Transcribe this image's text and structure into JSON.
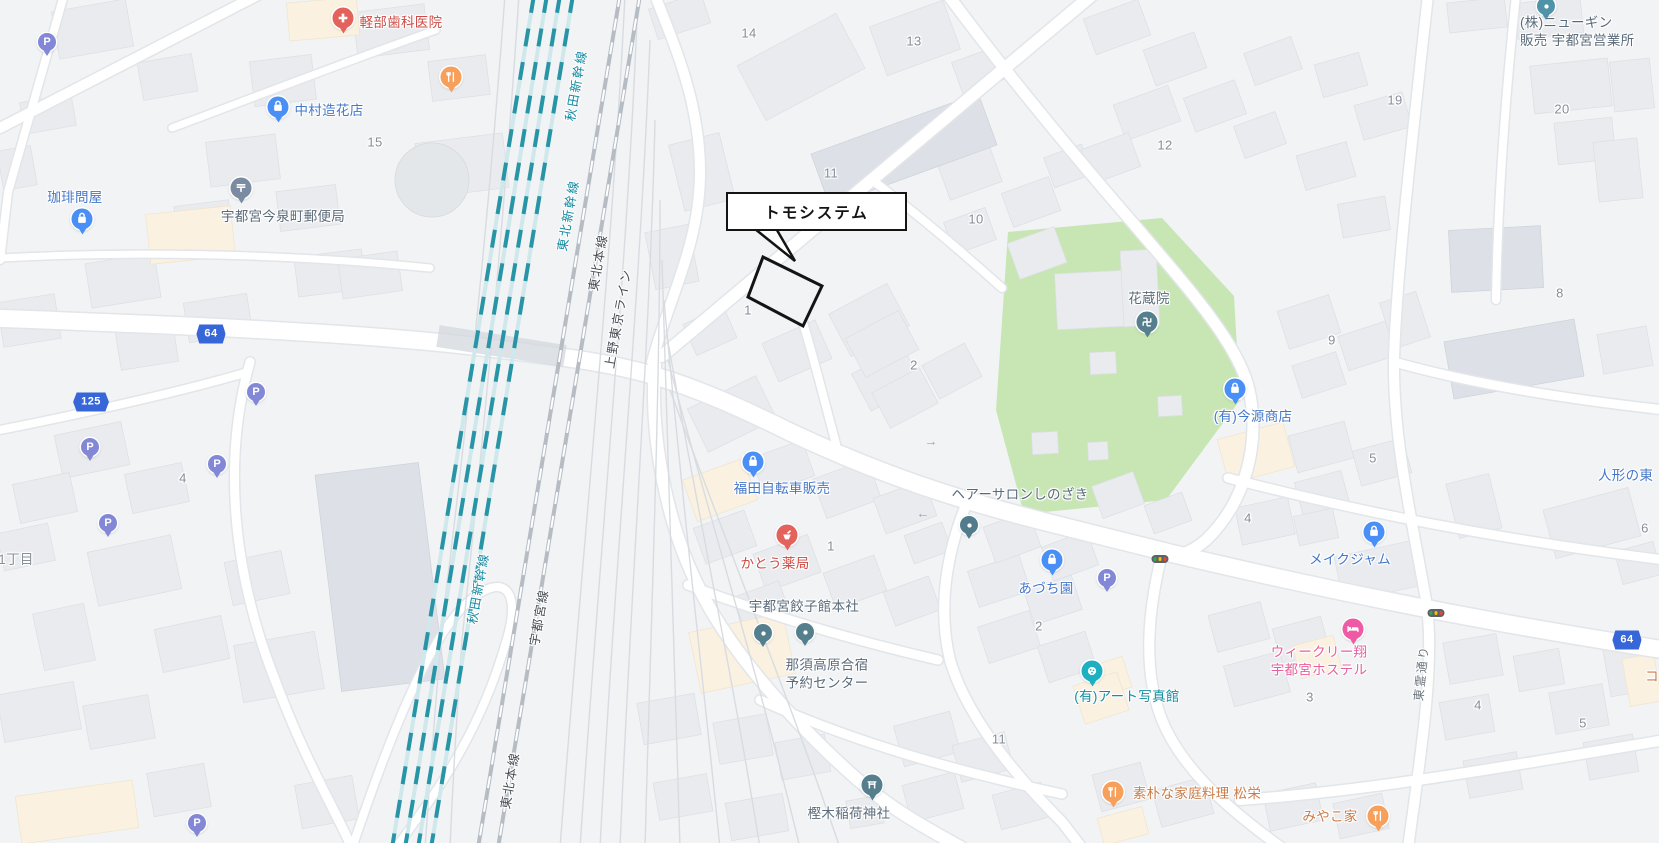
{
  "map": {
    "callout": {
      "text": "トモシステム"
    },
    "poi_labels": [
      {
        "text": "軽部歯科医院",
        "x": 401,
        "y": 23,
        "color": "#cd4b44"
      },
      {
        "text": "中村造花店",
        "x": 329,
        "y": 111,
        "color": "#4577c8"
      },
      {
        "text": "珈琲問屋",
        "x": 75,
        "y": 198,
        "color": "#4577c8"
      },
      {
        "text": "宇都宮今泉町郵便局",
        "x": 283,
        "y": 217,
        "color": "#5a6a7a"
      },
      {
        "text": "(株)ニューギン\n販売 宇都宮営業所",
        "x": 1520,
        "y": 14,
        "color": "#5a6a7a",
        "align": "left"
      },
      {
        "text": "花蔵院",
        "x": 1149,
        "y": 299,
        "color": "#5a6a7a"
      },
      {
        "text": "(有)今源商店",
        "x": 1253,
        "y": 417,
        "color": "#4577c8"
      },
      {
        "text": "人形の東",
        "x": 1598,
        "y": 467,
        "color": "#4577c8",
        "align": "left"
      },
      {
        "text": "福田自転車販売",
        "x": 782,
        "y": 489,
        "color": "#4577c8"
      },
      {
        "text": "かとう薬局",
        "x": 775,
        "y": 564,
        "color": "#cd4b44"
      },
      {
        "text": "ヘアーサロンしのざき",
        "x": 1020,
        "y": 495,
        "color": "#5a6a7a"
      },
      {
        "text": "あづち園",
        "x": 1046,
        "y": 589,
        "color": "#4577c8"
      },
      {
        "text": "(有)アート写真館",
        "x": 1127,
        "y": 697,
        "color": "#128fa0"
      },
      {
        "text": "メイクジャム",
        "x": 1350,
        "y": 560,
        "color": "#4577c8"
      },
      {
        "text": "ウィークリー翔\n宇都宮ホステル",
        "x": 1319,
        "y": 661,
        "color": "#e85f9f"
      },
      {
        "text": "宇都宮餃子館本社",
        "x": 804,
        "y": 607,
        "color": "#5a6a7a"
      },
      {
        "text": "那須高原合宿\n予約センター",
        "x": 827,
        "y": 674,
        "color": "#5a6a7a"
      },
      {
        "text": "樫木稲荷神社",
        "x": 849,
        "y": 814,
        "color": "#5a6a7a"
      },
      {
        "text": "素朴な家庭料理 松栄",
        "x": 1197,
        "y": 794,
        "color": "#c97c48"
      },
      {
        "text": "みやこ家",
        "x": 1330,
        "y": 817,
        "color": "#c97c48"
      },
      {
        "text": "コ",
        "x": 1652,
        "y": 677,
        "color": "#c97c48"
      },
      {
        "text": "1丁目",
        "x": 16,
        "y": 560,
        "color": "#8a919a"
      }
    ],
    "railway_labels": [
      {
        "text": "秋田新幹線",
        "x": 575,
        "y": 85,
        "angle": -80,
        "color": "#1389a0"
      },
      {
        "text": "東北新幹線",
        "x": 567,
        "y": 215,
        "angle": -80,
        "color": "#1389a0"
      },
      {
        "text": "東北本線",
        "x": 597,
        "y": 262,
        "angle": -80,
        "color": "#474e55"
      },
      {
        "text": "上野東京ライン",
        "x": 617,
        "y": 318,
        "angle": -80,
        "color": "#474e55"
      },
      {
        "text": "秋田新幹線",
        "x": 477,
        "y": 588,
        "angle": -80,
        "color": "#1389a0"
      },
      {
        "text": "宇都宮線",
        "x": 538,
        "y": 617,
        "angle": -80,
        "color": "#474e55"
      },
      {
        "text": "東北本線",
        "x": 509,
        "y": 780,
        "angle": -80,
        "color": "#474e55"
      }
    ],
    "street_labels": [
      {
        "text": "東霊通り",
        "x": 1421,
        "y": 673,
        "angle": -84,
        "color": "#6d767e"
      }
    ],
    "block_numbers": [
      {
        "text": "14",
        "x": 749,
        "y": 33
      },
      {
        "text": "13",
        "x": 914,
        "y": 41
      },
      {
        "text": "11",
        "x": 831,
        "y": 173
      },
      {
        "text": "10",
        "x": 976,
        "y": 219
      },
      {
        "text": "12",
        "x": 1165,
        "y": 145
      },
      {
        "text": "19",
        "x": 1395,
        "y": 100
      },
      {
        "text": "20",
        "x": 1562,
        "y": 109
      },
      {
        "text": "8",
        "x": 1560,
        "y": 293
      },
      {
        "text": "15",
        "x": 375,
        "y": 142
      },
      {
        "text": "1",
        "x": 748,
        "y": 310
      },
      {
        "text": "2",
        "x": 914,
        "y": 365
      },
      {
        "text": "9",
        "x": 1332,
        "y": 340
      },
      {
        "text": "5",
        "x": 1373,
        "y": 458
      },
      {
        "text": "4",
        "x": 1248,
        "y": 518
      },
      {
        "text": "6",
        "x": 1645,
        "y": 528
      },
      {
        "text": "4",
        "x": 183,
        "y": 478
      },
      {
        "text": "1",
        "x": 831,
        "y": 546
      },
      {
        "text": "2",
        "x": 1039,
        "y": 626
      },
      {
        "text": "3",
        "x": 1310,
        "y": 697
      },
      {
        "text": "11",
        "x": 999,
        "y": 739
      },
      {
        "text": "4",
        "x": 1478,
        "y": 705
      },
      {
        "text": "5",
        "x": 1583,
        "y": 723
      }
    ],
    "road_shields": [
      {
        "text": "64",
        "x": 211,
        "y": 334
      },
      {
        "text": "125",
        "x": 91,
        "y": 402
      },
      {
        "text": "64",
        "x": 1627,
        "y": 640
      }
    ],
    "pins": [
      {
        "type": "hospital",
        "x": 343,
        "y": 18,
        "color": "#e4625c"
      },
      {
        "type": "bag",
        "x": 278,
        "y": 107,
        "color": "#4a8ff5"
      },
      {
        "type": "restaurant",
        "x": 451,
        "y": 77,
        "color": "#f7a05c"
      },
      {
        "type": "parking",
        "x": 47,
        "y": 42,
        "color": "#8287d6"
      },
      {
        "type": "post",
        "x": 241,
        "y": 188,
        "color": "#7b8ca2"
      },
      {
        "type": "bag",
        "x": 82,
        "y": 219,
        "color": "#4a8ff5"
      },
      {
        "type": "parking",
        "x": 256,
        "y": 392,
        "color": "#8287d6"
      },
      {
        "type": "parking",
        "x": 90,
        "y": 447,
        "color": "#8287d6"
      },
      {
        "type": "parking",
        "x": 217,
        "y": 464,
        "color": "#8287d6"
      },
      {
        "type": "parking",
        "x": 108,
        "y": 523,
        "color": "#8287d6"
      },
      {
        "type": "parking",
        "x": 197,
        "y": 823,
        "color": "#8287d6"
      },
      {
        "type": "parking",
        "x": 1107,
        "y": 578,
        "color": "#8287d6"
      },
      {
        "type": "bag",
        "x": 753,
        "y": 462,
        "color": "#4a8ff5"
      },
      {
        "type": "pharmacy",
        "x": 787,
        "y": 535,
        "color": "#e4625c"
      },
      {
        "type": "dot",
        "x": 969,
        "y": 525,
        "color": "#527c8c"
      },
      {
        "type": "bag",
        "x": 1052,
        "y": 560,
        "color": "#4a8ff5"
      },
      {
        "type": "palette",
        "x": 1092,
        "y": 671,
        "color": "#1cb0c0"
      },
      {
        "type": "bag",
        "x": 1374,
        "y": 532,
        "color": "#4a8ff5"
      },
      {
        "type": "bed",
        "x": 1353,
        "y": 629,
        "color": "#ee5aa3"
      },
      {
        "type": "restaurant",
        "x": 1113,
        "y": 792,
        "color": "#f7a05c"
      },
      {
        "type": "restaurant",
        "x": 1378,
        "y": 816,
        "color": "#f7a05c"
      },
      {
        "type": "torii",
        "x": 872,
        "y": 785,
        "color": "#567f8d"
      },
      {
        "type": "manji",
        "x": 1147,
        "y": 322,
        "color": "#567f8d"
      },
      {
        "type": "dot",
        "x": 763,
        "y": 633,
        "color": "#567f8d"
      },
      {
        "type": "dot",
        "x": 805,
        "y": 632,
        "color": "#567f8d"
      },
      {
        "type": "dot",
        "x": 1546,
        "y": 6,
        "color": "#4e93a8"
      },
      {
        "type": "bag",
        "x": 1235,
        "y": 389,
        "color": "#4a8ff5"
      }
    ],
    "traffic_lights": [
      {
        "x": 1160,
        "y": 559
      },
      {
        "x": 1436,
        "y": 613
      }
    ],
    "one_way_arrows": [
      {
        "x": 931,
        "y": 441,
        "dir": "→"
      },
      {
        "x": 923,
        "y": 513,
        "dir": "←"
      }
    ]
  }
}
